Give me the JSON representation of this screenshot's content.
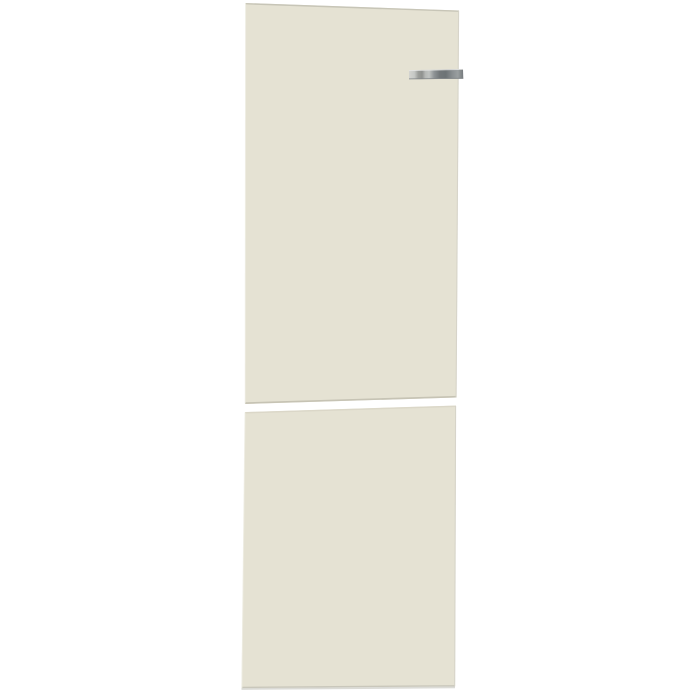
{
  "page": {
    "background_color": "#ffffff"
  },
  "product_photo": {
    "description": "Cream-colored two-section refrigerator door panel set shown front-on against a white background, with a small chrome brand strip near the top right of the upper panel",
    "colors": {
      "panel": "#e5e2d3",
      "panel_top_edge": "#c2bfb1",
      "panel_bottom_edge": "#c6c3b4",
      "panel_right_edge": "#d5d3c8",
      "panel_left_highlight": "#efeee3",
      "lower_top_edge": "#d9d6c7",
      "lower_bottom_edge": "#c9c7bb",
      "underside": "#d7d7d2",
      "gap": "#ffffff"
    },
    "brand_strip": {
      "highlight": "#e8e9e7",
      "shadow": "#83878a",
      "grad_0": "#d3d4d0",
      "grad_1": "#c6c8c5",
      "grad_2": "#9b9d9a",
      "grad_3": "#8f918e",
      "grad_4": "#b5b8b5",
      "grad_5": "#c0c3c1",
      "grad_6": "#8f9496",
      "grad_7": "#73787a",
      "grad_8": "#6d7375",
      "grad_9": "#8a8f91",
      "grad_10": "#9a9fa0",
      "grad_11": "#74797c"
    }
  }
}
